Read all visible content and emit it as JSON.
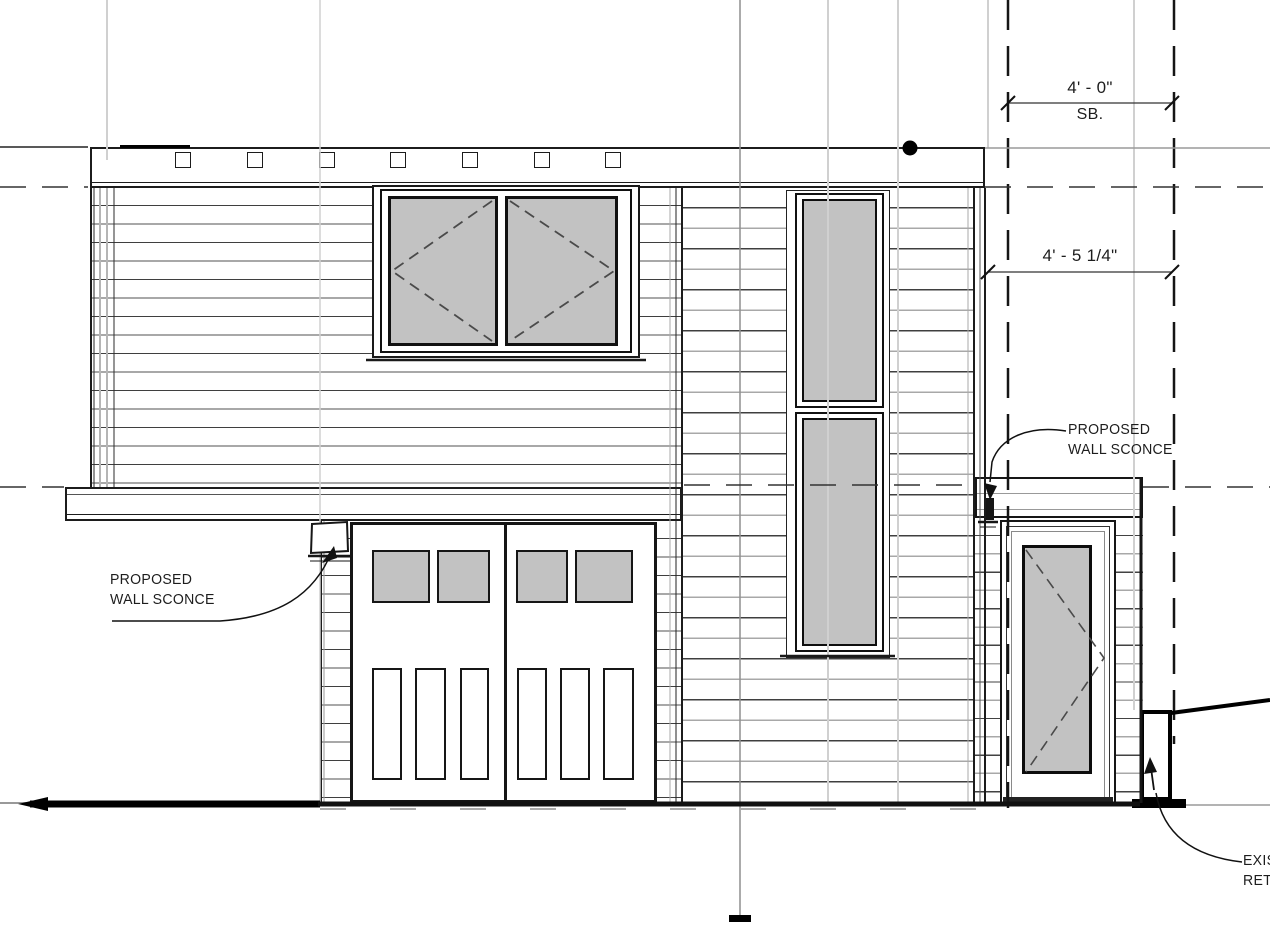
{
  "colors": {
    "glazing": "#c2c2c2",
    "line": "#1a1a1a",
    "grid": "#d0d0d0",
    "centerline": "#8f8f8f"
  },
  "dimensions": {
    "setback": {
      "value": "4' - 0\"",
      "label": "SB."
    },
    "side": {
      "value": "4' - 5 1/4\""
    }
  },
  "callouts": {
    "sconce_left": {
      "line1": "PROPOSED",
      "line2": "WALL SCONCE"
    },
    "sconce_right": {
      "line1": "PROPOSED",
      "line2": "WALL SCONCE"
    },
    "retaining": {
      "line1": "EXIST",
      "line2": "RETAI"
    }
  }
}
